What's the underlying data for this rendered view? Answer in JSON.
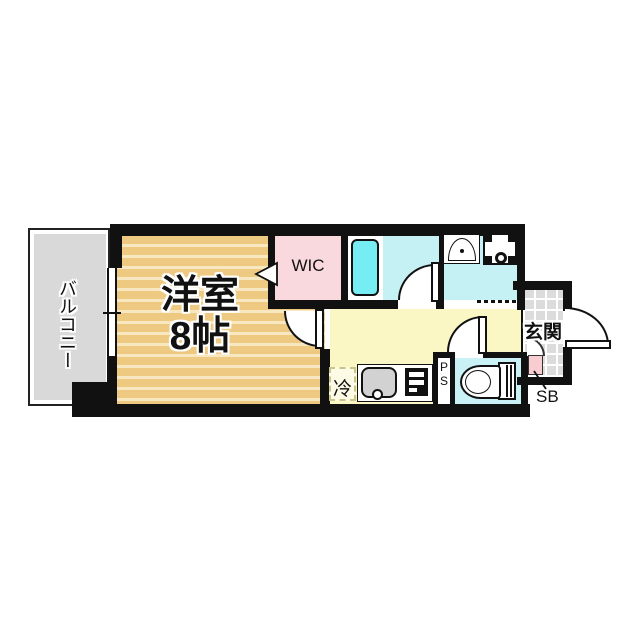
{
  "floor_plan": {
    "balcony_label": "バルコニー",
    "room_label": "洋室",
    "room_size_label": "8帖",
    "wic_label": "WIC",
    "entrance_label": "玄関",
    "refrigerator_label": "冷",
    "pipe_space_letters": [
      "P",
      "S"
    ],
    "shoe_box_label": "SB",
    "colors": {
      "wall": "#111111",
      "balcony_floor": "#d9d9d9",
      "room_floor": "#edc981",
      "room_floor_stripe": "#f8e8c2",
      "wic_floor": "#f9d8de",
      "bathroom_floor": "#c6f1f4",
      "bathtub": "#76edf2",
      "kitchen_floor": "#fbf7c5",
      "toilet_floor": "#c9f1f6",
      "entrance_tile": "#dcdcdc",
      "shoe_box": "#f7cdd2"
    },
    "fixtures": [
      "bathtub",
      "washbasin",
      "washing-machine-pan",
      "kitchen-sink",
      "gas-stove",
      "refrigerator-space",
      "toilet",
      "shoe-box",
      "entrance-door",
      "window"
    ]
  }
}
